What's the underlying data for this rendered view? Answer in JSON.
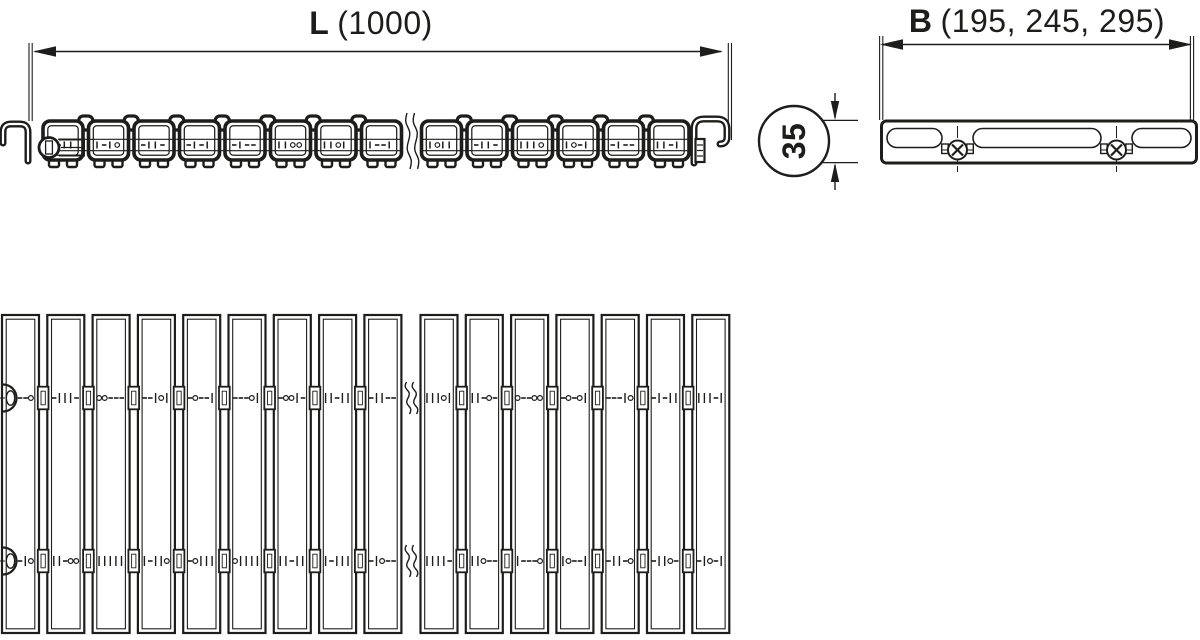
{
  "drawing": {
    "type": "technical-drawing-drain-grate",
    "labels": {
      "length_letter": "L",
      "length_value": "(1000)",
      "width_letter": "B",
      "width_value": "(195, 245, 295)",
      "profile_height": "35"
    },
    "side_view": {
      "modules_before_break": 8,
      "modules_after_break": 6,
      "has_break": true
    },
    "plan_view": {
      "slats_before_break": 9,
      "slats_after_break": 7,
      "rail_rows": 2,
      "has_break": true
    },
    "end_view": {
      "screw_count": 2
    },
    "colors": {
      "line": "#1d1d1b",
      "background": "#ffffff"
    }
  }
}
